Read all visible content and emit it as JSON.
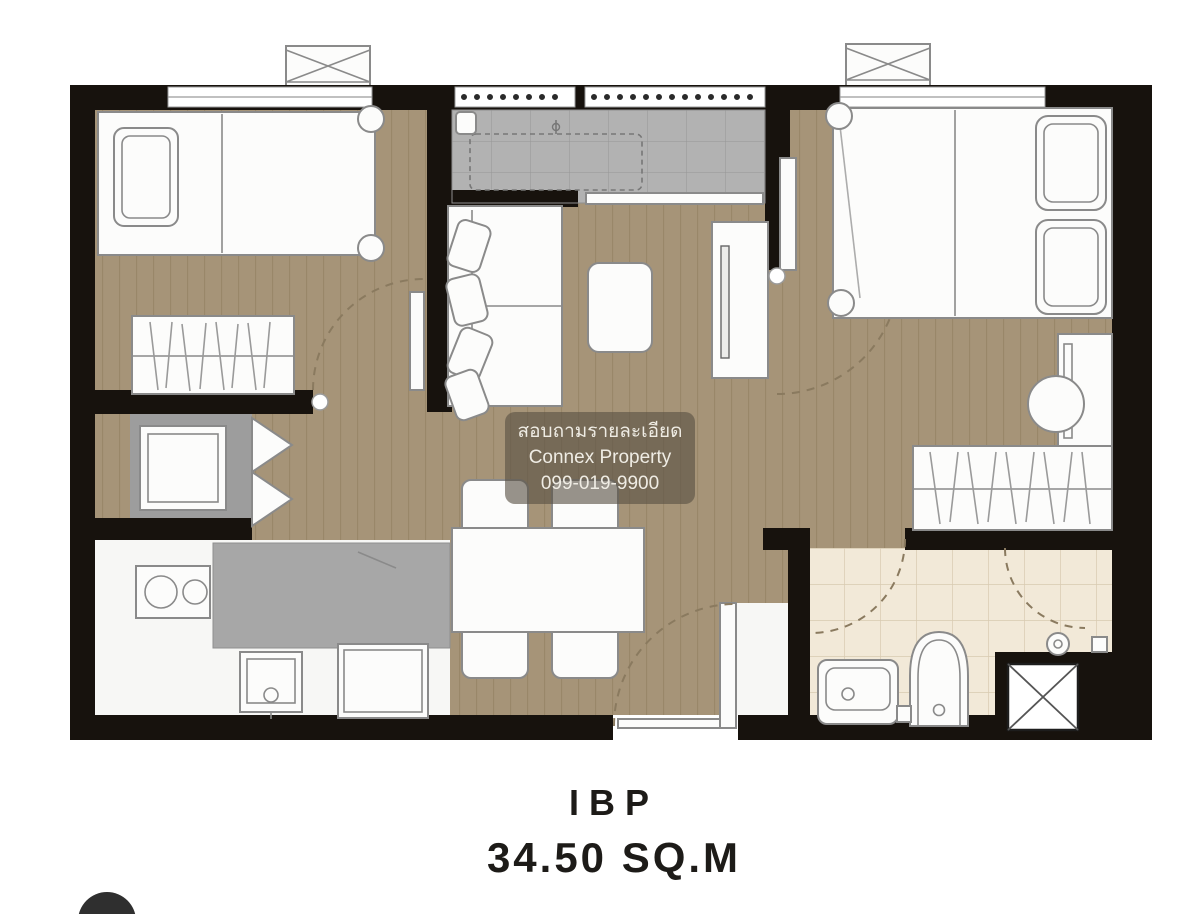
{
  "watermark": {
    "line1": "สอบถามรายละเอียด",
    "line2": "Connex Property",
    "line3": "099-019-9900"
  },
  "plan_label": {
    "unit_type": "IBP",
    "area": "34.50 SQ.M"
  },
  "colors": {
    "wall": "#17120d",
    "wood_floor": "#a69478",
    "plank_line": "#8e7c5c",
    "kitchen_gray": "#b2b2b2",
    "counter_gray": "#a7a7a7",
    "alcove_gray": "#9d9d9d",
    "bath_floor": "#f2e9d8",
    "bath_grid": "#d8cab1",
    "furniture_fill": "#fcfcfb",
    "furniture_stroke": "#8a8a8a",
    "watermark_bg": "rgba(88,80,68,0.62)",
    "watermark_text": "#efece4",
    "label_text": "#1d1b18",
    "page_bg": "#ffffff"
  },
  "furniture_symbols": [
    "air-conditioner",
    "single-bed",
    "pillow",
    "wardrobe",
    "refrigerator",
    "stove",
    "kitchen-sink",
    "washing-machine",
    "kitchen-counter",
    "sofa",
    "coffee-table",
    "tv-console",
    "dining-table",
    "dining-chair",
    "double-bed",
    "vanity-desk",
    "stool",
    "bathroom-vanity",
    "toilet",
    "shower",
    "ventilation-shaft",
    "door-swing",
    "window"
  ]
}
